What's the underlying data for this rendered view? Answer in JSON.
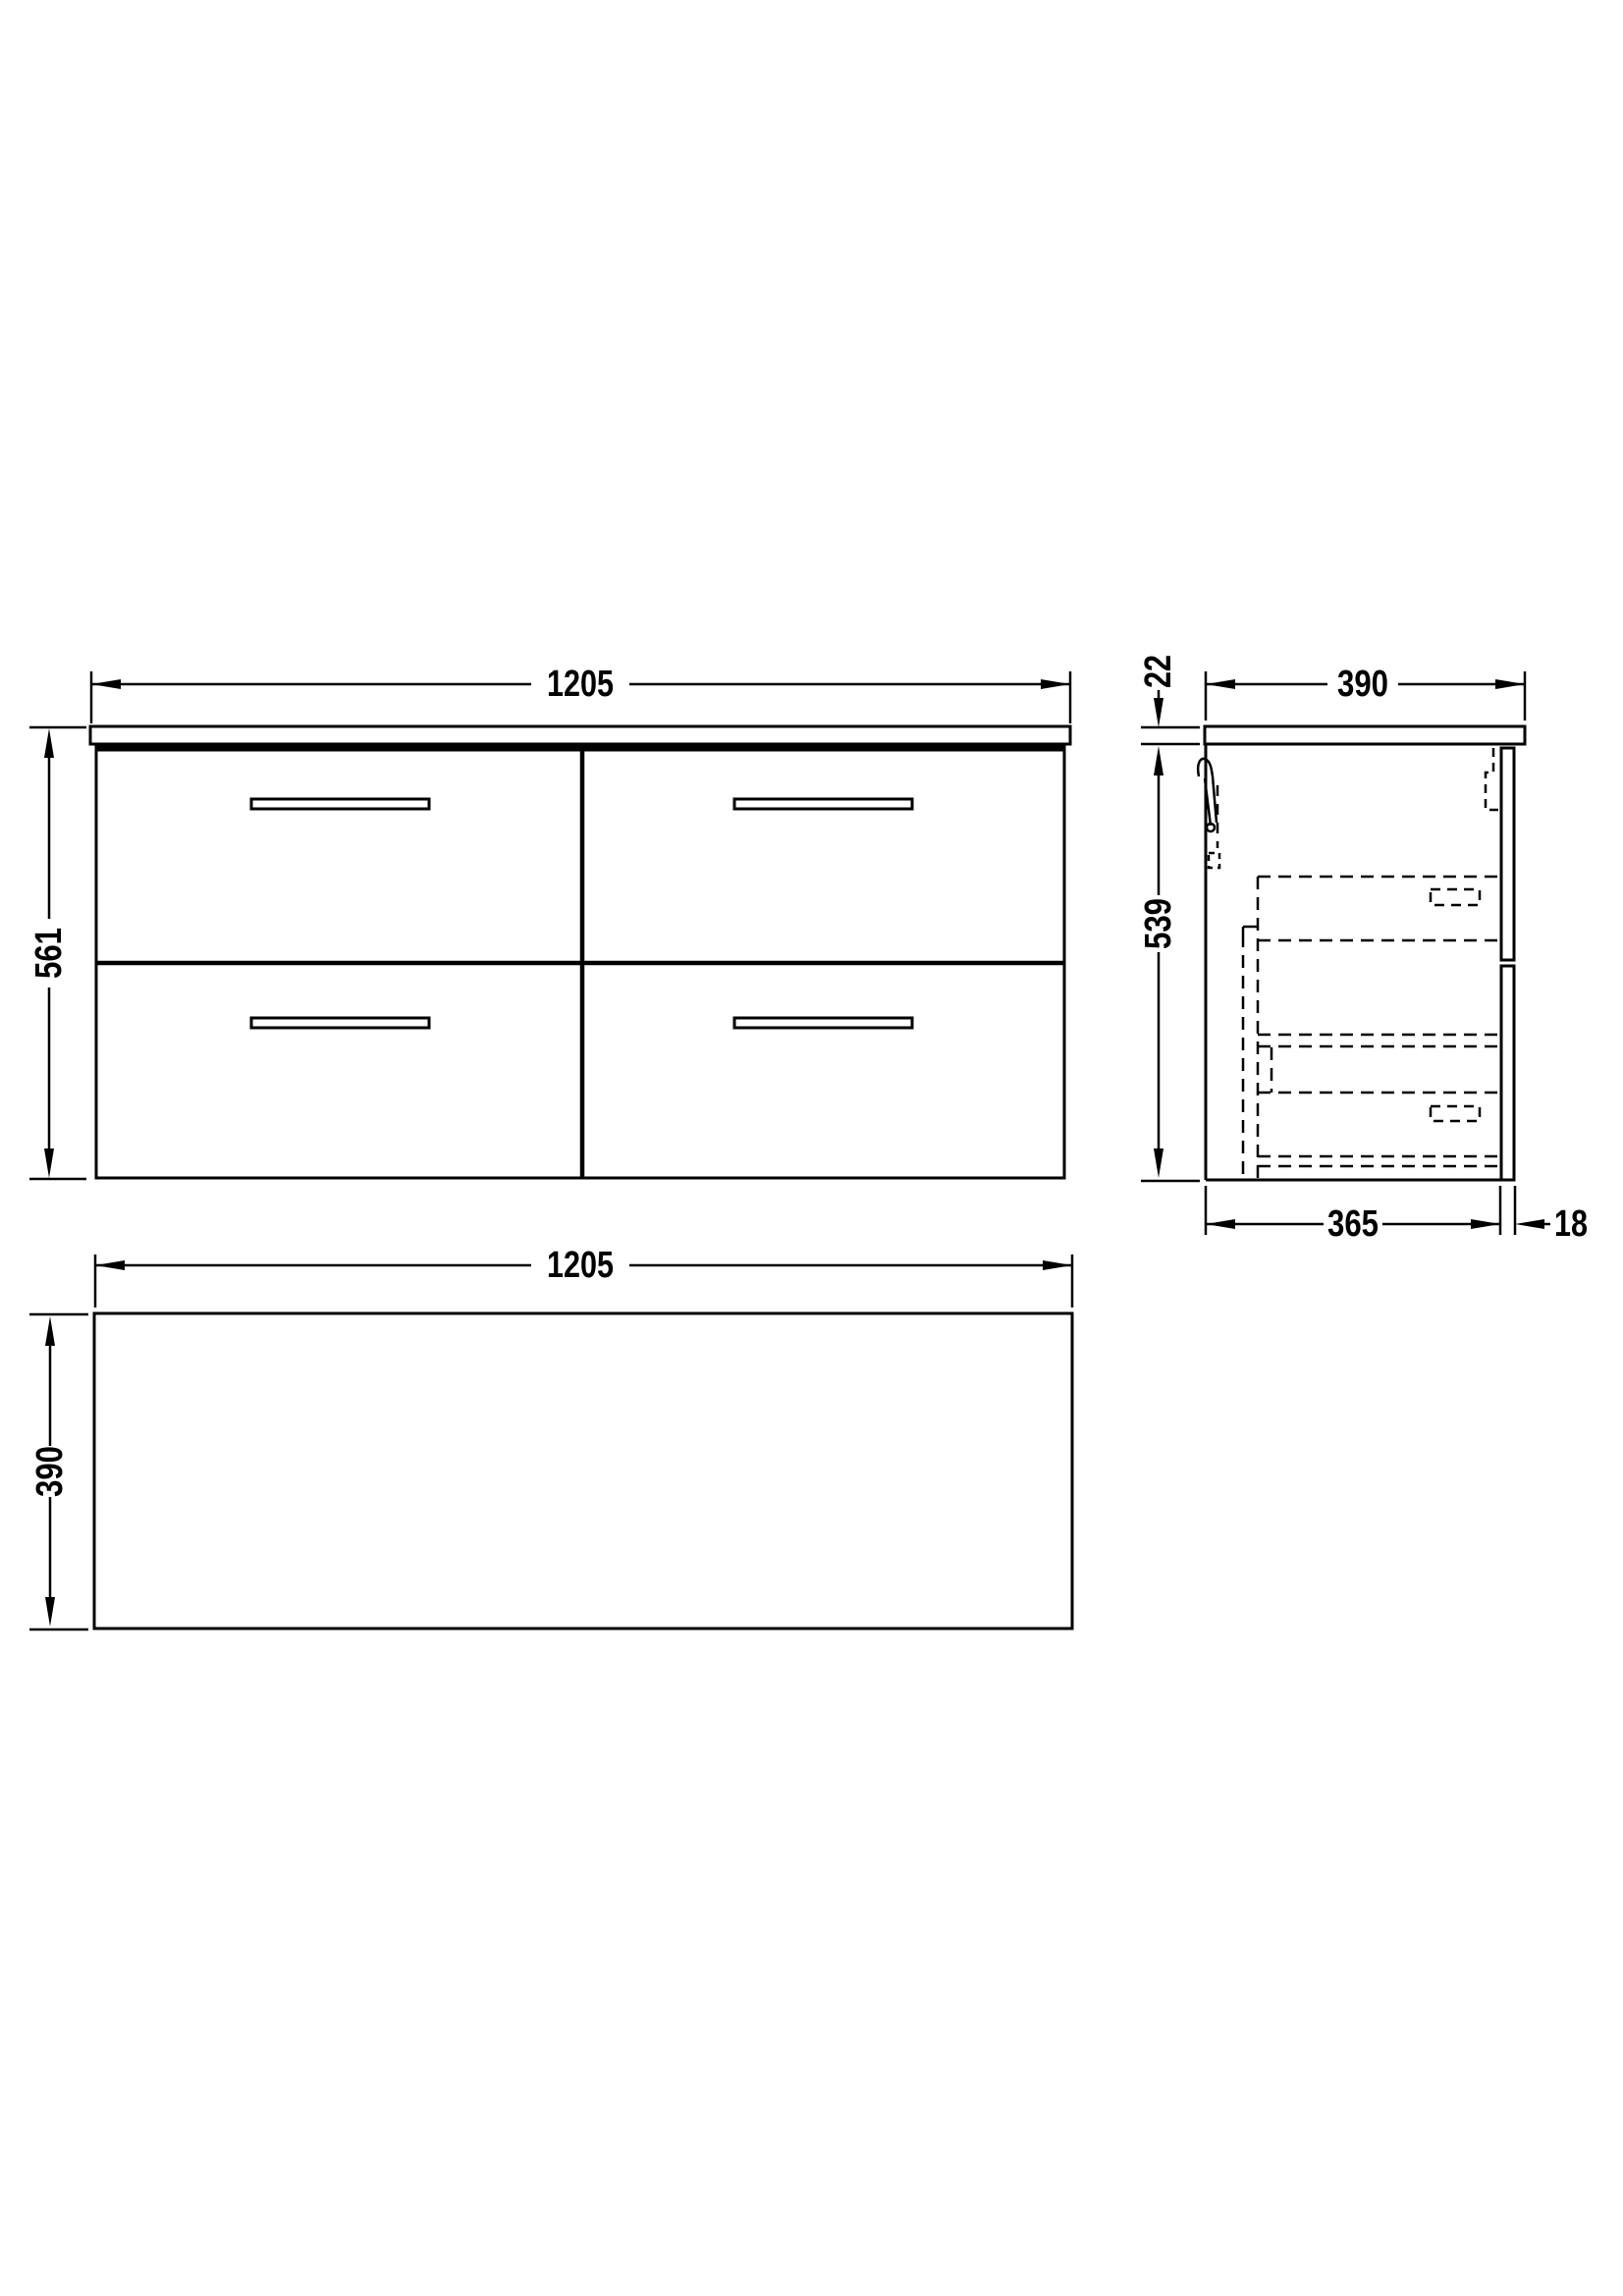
{
  "document": {
    "background": "#ffffff",
    "line_color": "#000000"
  },
  "views": {
    "front": {
      "dims": {
        "width": "1205",
        "height": "561"
      }
    },
    "side": {
      "dims": {
        "width": "390",
        "worktop_thickness": "22",
        "body_height": "539",
        "body_depth": "365",
        "panel_thickness": "18"
      }
    },
    "plan": {
      "dims": {
        "width": "1205",
        "depth": "390"
      }
    }
  }
}
